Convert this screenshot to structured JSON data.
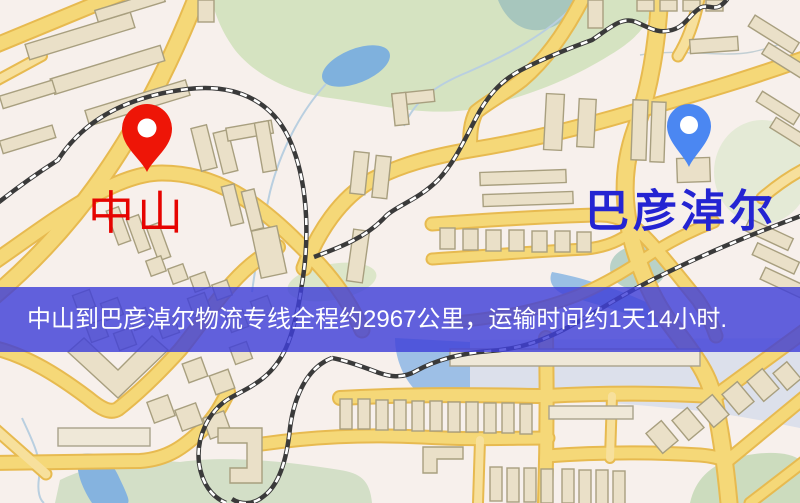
{
  "markers": {
    "origin": {
      "label": "中山",
      "label_color": "#e60300",
      "pin_color": "#ee1507",
      "pin_icon": "red-location-pin"
    },
    "destination": {
      "label": "巴彦淖尔",
      "label_color": "#2424d2",
      "pin_color": "#4b87f2",
      "pin_icon": "blue-location-pin"
    }
  },
  "banner": {
    "text": "中山到巴彦淖尔物流专线全程约2967公里，运输时间约1天14小时.",
    "background_color": "rgba(64,64,216,0.82)",
    "text_color": "#ffffff",
    "route": {
      "origin": "中山",
      "destination": "巴彦淖尔",
      "distance_km": "2967",
      "duration": "1天14小时"
    }
  },
  "map_style": {
    "background": "#f7f0ec",
    "road_fill": "#f5d878",
    "road_casing": "#e7ba50",
    "minor_road_fill": "#f7e09c",
    "building_fill": "#eae0c8",
    "building_stroke": "#a89f7f",
    "park_green": "#d5e3c1",
    "water_blue": "#7fb1dd",
    "railway": "#3a3a3a"
  }
}
